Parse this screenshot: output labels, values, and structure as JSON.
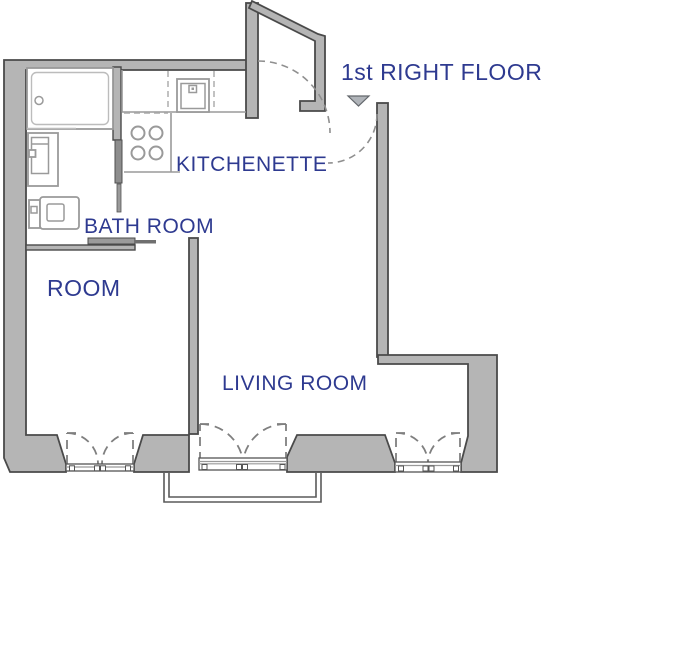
{
  "floor_plan": {
    "labels": {
      "title": "1st RIGHT FLOOR",
      "kitchenette": "KITCHENETTE",
      "bathroom": "BATH ROOM",
      "room": "ROOM",
      "living_room": "LIVING ROOM"
    },
    "colors": {
      "label_text": "#2e3a90",
      "wall_fill": "#b5b5b5",
      "wall_outline": "#4a4a4a",
      "fixture_line": "#9a9a9a"
    },
    "fixtures": [
      "bathtub",
      "vanity-sink",
      "toilet",
      "kitchen-sink",
      "stove-4-burners"
    ],
    "windows_count": 3,
    "doors": [
      "entrance-door-swing",
      "apartment-door-swing",
      "bathroom-sliding-door",
      "room-pocket-door"
    ]
  }
}
